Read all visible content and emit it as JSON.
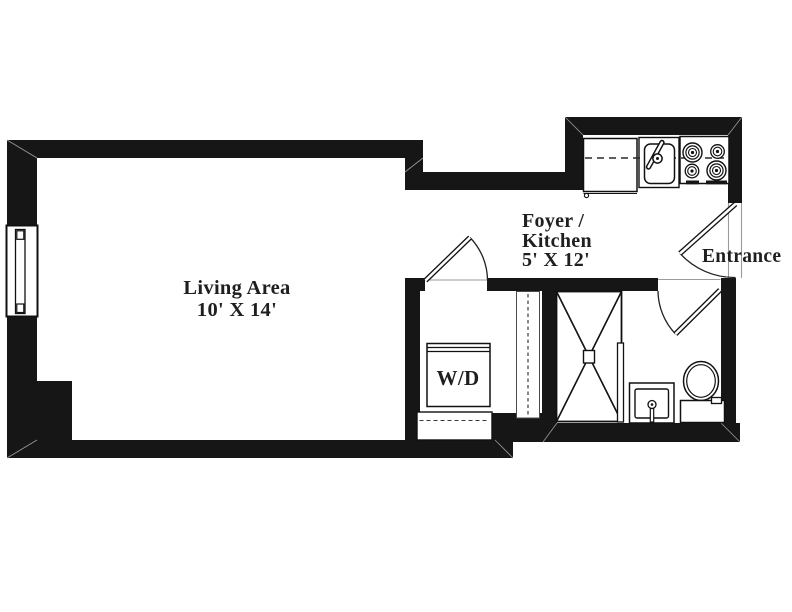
{
  "plan": {
    "living": {
      "name": "Living Area",
      "dims": "10' X 14'"
    },
    "foyer": {
      "name_line1": "Foyer /",
      "name_line2": "Kitchen",
      "dims": "5' X 12'"
    },
    "entrance": {
      "label": "Entrance"
    },
    "laundry": {
      "label": "W/D"
    }
  },
  "colors": {
    "wall": "#161616",
    "line": "#1b1b1b",
    "muted_line": "#979797",
    "background": "#ffffff",
    "text": "#1f1f1f"
  }
}
